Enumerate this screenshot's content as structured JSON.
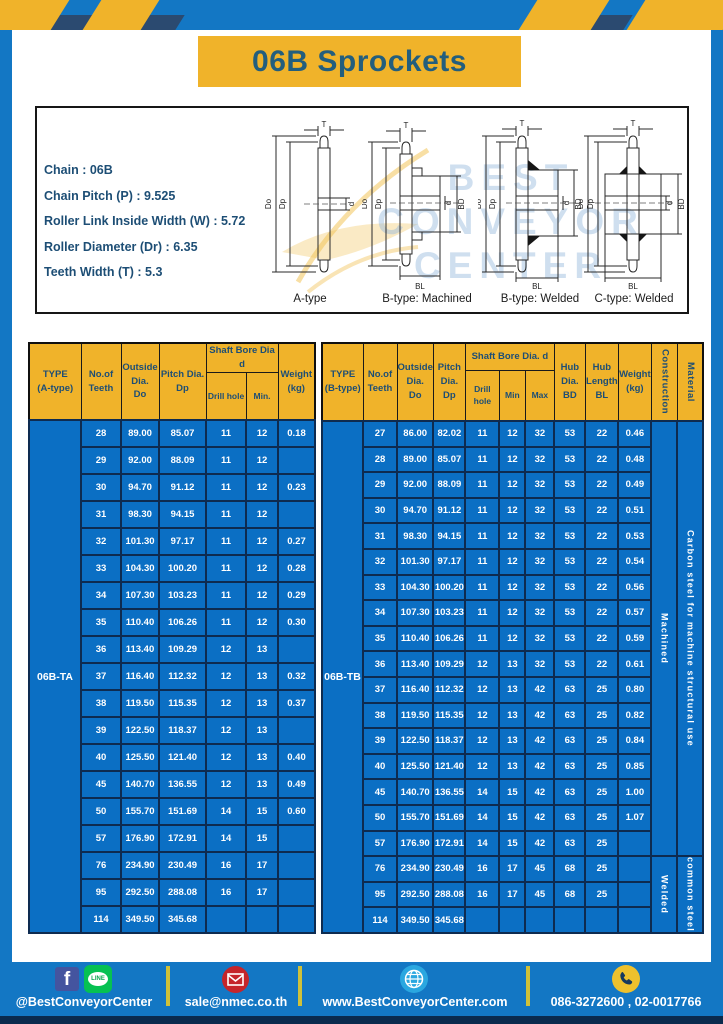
{
  "header": {
    "title": "06B Sprockets"
  },
  "specs": {
    "lines": [
      "Chain : 06B",
      "Chain Pitch (P) : 9.525",
      "Roller Link Inside Width (W) : 5.72",
      "Roller Diameter (Dr) : 6.35",
      "Teeth Width (T) : 5.3"
    ]
  },
  "diagram": {
    "watermark": [
      "BEST",
      "CONVEYOR",
      "CENTER"
    ],
    "dims": {
      "t": "T",
      "do": "Do",
      "dp": "Dp",
      "d": "d",
      "bd": "BD",
      "bl": "BL"
    },
    "types": [
      {
        "label": "A-type"
      },
      {
        "label": "B-type: Machined"
      },
      {
        "label": "B-type: Welded"
      },
      {
        "label": "C-type: Welded"
      }
    ]
  },
  "table_a": {
    "name": "a-type",
    "type_label": "06B-TA",
    "col_widths": [
      52,
      40,
      38,
      47,
      40,
      32,
      37
    ],
    "header_row_heights": [
      26,
      48
    ],
    "row_height": 27,
    "header_rows": [
      [
        {
          "t": "TYPE\n(A-type)",
          "rs": 2
        },
        {
          "t": "No.of\nTeeth",
          "rs": 2
        },
        {
          "t": "Outside\nDia.\nDo",
          "rs": 2
        },
        {
          "t": "Pitch Dia.\nDp",
          "rs": 2
        },
        {
          "t": "Shaft Bore Dia d",
          "cs": 2
        },
        {
          "t": "Weight\n(kg)",
          "rs": 2
        }
      ],
      [
        {
          "t": "Drill hole",
          "cls": "sub"
        },
        {
          "t": "Min.",
          "cls": "sub"
        }
      ]
    ],
    "rows": [
      [
        "28",
        "89.00",
        "85.07",
        "11",
        "12",
        "0.18"
      ],
      [
        "29",
        "92.00",
        "88.09",
        "11",
        "12",
        ""
      ],
      [
        "30",
        "94.70",
        "91.12",
        "11",
        "12",
        "0.23"
      ],
      [
        "31",
        "98.30",
        "94.15",
        "11",
        "12",
        ""
      ],
      [
        "32",
        "101.30",
        "97.17",
        "11",
        "12",
        "0.27"
      ],
      [
        "33",
        "104.30",
        "100.20",
        "11",
        "12",
        "0.28"
      ],
      [
        "34",
        "107.30",
        "103.23",
        "11",
        "12",
        "0.29"
      ],
      [
        "35",
        "110.40",
        "106.26",
        "11",
        "12",
        "0.30"
      ],
      [
        "36",
        "113.40",
        "109.29",
        "12",
        "13",
        ""
      ],
      [
        "37",
        "116.40",
        "112.32",
        "12",
        "13",
        "0.32"
      ],
      [
        "38",
        "119.50",
        "115.35",
        "12",
        "13",
        "0.37"
      ],
      [
        "39",
        "122.50",
        "118.37",
        "12",
        "13",
        ""
      ],
      [
        "40",
        "125.50",
        "121.40",
        "12",
        "13",
        "0.40"
      ],
      [
        "45",
        "140.70",
        "136.55",
        "12",
        "13",
        "0.49"
      ],
      [
        "50",
        "155.70",
        "151.69",
        "14",
        "15",
        "0.60"
      ],
      [
        "57",
        "176.90",
        "172.91",
        "14",
        "15",
        ""
      ],
      [
        "76",
        "234.90",
        "230.49",
        "16",
        "17",
        ""
      ],
      [
        "95",
        "292.50",
        "288.08",
        "16",
        "17",
        ""
      ],
      [
        "114",
        "349.50",
        "345.68",
        "",
        "",
        ""
      ]
    ]
  },
  "table_b": {
    "name": "b-type",
    "type_label": "06B-TB",
    "col_widths": [
      41,
      34,
      33,
      32,
      34,
      26,
      29,
      31,
      33,
      33,
      26,
      26
    ],
    "header_row_heights": [
      27,
      51
    ],
    "row_height": 25.6,
    "header_rows": [
      [
        {
          "t": "TYPE\n(B-type)",
          "rs": 2
        },
        {
          "t": "No.of\nTeeth",
          "rs": 2
        },
        {
          "t": "Outside\nDia.\nDo",
          "rs": 2
        },
        {
          "t": "Pitch\nDia.\nDp",
          "rs": 2
        },
        {
          "t": "Shaft Bore Dia. d",
          "cs": 3
        },
        {
          "t": "Hub\nDia.\nBD",
          "rs": 2
        },
        {
          "t": "Hub\nLength\nBL",
          "rs": 2
        },
        {
          "t": "Weight\n(kg)",
          "rs": 2
        },
        {
          "t": "Construction",
          "rs": 2,
          "cls": "vhead"
        },
        {
          "t": "Material",
          "rs": 2,
          "cls": "vhead"
        }
      ],
      [
        {
          "t": "Drill hole",
          "cls": "sub"
        },
        {
          "t": "Min",
          "cls": "sub"
        },
        {
          "t": "Max",
          "cls": "sub"
        }
      ]
    ],
    "rows": [
      [
        "27",
        "86.00",
        "82.02",
        "11",
        "12",
        "32",
        "53",
        "22",
        "0.46"
      ],
      [
        "28",
        "89.00",
        "85.07",
        "11",
        "12",
        "32",
        "53",
        "22",
        "0.48"
      ],
      [
        "29",
        "92.00",
        "88.09",
        "11",
        "12",
        "32",
        "53",
        "22",
        "0.49"
      ],
      [
        "30",
        "94.70",
        "91.12",
        "11",
        "12",
        "32",
        "53",
        "22",
        "0.51"
      ],
      [
        "31",
        "98.30",
        "94.15",
        "11",
        "12",
        "32",
        "53",
        "22",
        "0.53"
      ],
      [
        "32",
        "101.30",
        "97.17",
        "11",
        "12",
        "32",
        "53",
        "22",
        "0.54"
      ],
      [
        "33",
        "104.30",
        "100.20",
        "11",
        "12",
        "32",
        "53",
        "22",
        "0.56"
      ],
      [
        "34",
        "107.30",
        "103.23",
        "11",
        "12",
        "32",
        "53",
        "22",
        "0.57"
      ],
      [
        "35",
        "110.40",
        "106.26",
        "11",
        "12",
        "32",
        "53",
        "22",
        "0.59"
      ],
      [
        "36",
        "113.40",
        "109.29",
        "12",
        "13",
        "32",
        "53",
        "22",
        "0.61"
      ],
      [
        "37",
        "116.40",
        "112.32",
        "12",
        "13",
        "42",
        "63",
        "25",
        "0.80"
      ],
      [
        "38",
        "119.50",
        "115.35",
        "12",
        "13",
        "42",
        "63",
        "25",
        "0.82"
      ],
      [
        "39",
        "122.50",
        "118.37",
        "12",
        "13",
        "42",
        "63",
        "25",
        "0.84"
      ],
      [
        "40",
        "125.50",
        "121.40",
        "12",
        "13",
        "42",
        "63",
        "25",
        "0.85"
      ],
      [
        "45",
        "140.70",
        "136.55",
        "14",
        "15",
        "42",
        "63",
        "25",
        "1.00"
      ],
      [
        "50",
        "155.70",
        "151.69",
        "14",
        "15",
        "42",
        "63",
        "25",
        "1.07"
      ],
      [
        "57",
        "176.90",
        "172.91",
        "14",
        "15",
        "42",
        "63",
        "25",
        ""
      ],
      [
        "76",
        "234.90",
        "230.49",
        "16",
        "17",
        "45",
        "68",
        "25",
        ""
      ],
      [
        "95",
        "292.50",
        "288.08",
        "16",
        "17",
        "45",
        "68",
        "25",
        ""
      ],
      [
        "114",
        "349.50",
        "345.68",
        "",
        "",
        "",
        "",
        "",
        ""
      ]
    ],
    "vcols": [
      {
        "name": "construction",
        "spans": [
          {
            "label": "Machined",
            "rows": 17
          },
          {
            "label": "Welded",
            "rows": 3
          }
        ]
      },
      {
        "name": "material",
        "spans": [
          {
            "label": "Carbon  steel  for  machine  structural  use",
            "rows": 17
          },
          {
            "label": "common steel",
            "rows": 3
          }
        ]
      }
    ]
  },
  "footer": {
    "facebook_glyph": "f",
    "line_label": "LINE",
    "social_handle": "@BestConveyorCenter",
    "email": "sale@nmec.co.th",
    "website": "www.BestConveyorCenter.com",
    "phones": "086-3272600 , 02-0017766"
  },
  "colors": {
    "frame_blue": "#1377c4",
    "table_cell_blue": "#0b6fc4",
    "table_border_navy": "#0e2b50",
    "accent_yellow": "#f0b32a",
    "heading_navy": "#1d4e75",
    "footer_bottom_navy": "#0a2a4d"
  }
}
